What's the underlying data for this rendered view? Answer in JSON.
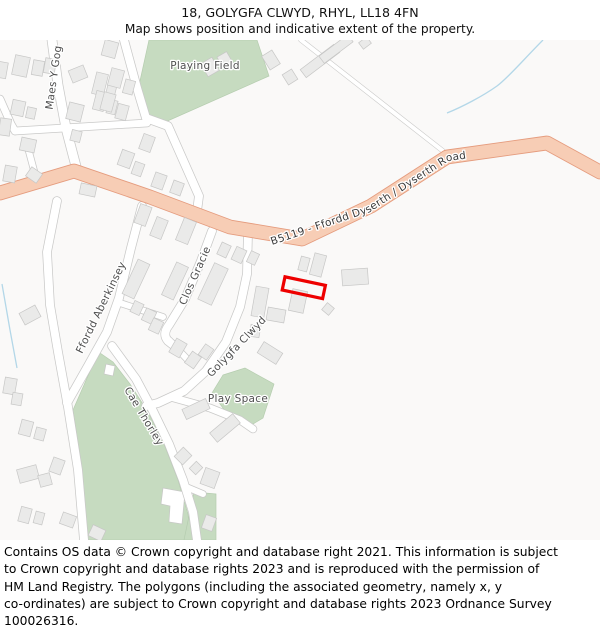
{
  "header": {
    "title": "18, GOLYGFA CLWYD, RHYL, LL18 4FN",
    "subtitle": "Map shows position and indicative extent of the property."
  },
  "map": {
    "colors": {
      "background": "#faf9f8",
      "building_fill": "#eaeae9",
      "building_stroke": "#c7c7c6",
      "road_fill": "#ffffff",
      "road_casing": "#c9c9c8",
      "a_road_fill": "#f7cdb5",
      "a_road_casing": "#e59c7e",
      "green": "#c6dbc0",
      "green_stroke": "#b5cdaf",
      "water": "#b3d7e8",
      "property_outline": "#ee0000",
      "label_color": "#4f4f4f"
    },
    "greens": [
      {
        "name": "playing-field",
        "points": "149,40 257,40 269,76 163,123 148,117 138,90"
      },
      {
        "name": "cae-thorley-field",
        "points": "100,353 113,362 130,384 148,412 164,444 178,480 188,514 190,540 88,540 82,470 73,410 91,369"
      },
      {
        "name": "southeast-green",
        "points": "184,540 194,492 216,494 216,540"
      },
      {
        "name": "play-space-green",
        "points": "223,375 245,368 274,384 263,418 248,427 228,415 212,393"
      }
    ],
    "white_plots": [
      "163,488 185,492 182,524 169,522 170,506 161,504",
      "106,364 115,366 113,376 104,374"
    ],
    "streams": [
      "M 543,40 C 525,58 508,78 497,86 C 483,96 462,107 447,113",
      "M 2,284 L 10,330 L 17,368"
    ],
    "roads": [
      {
        "d": "M 52,40 L 58,85 L 66,128 L 73,155 L 77,170",
        "w": 9
      },
      {
        "d": "M 15,131 L 147,123",
        "w": 7
      },
      {
        "d": "M 0,99 L 11,124 L 15,131",
        "w": 7
      },
      {
        "d": "M 124,40 L 137,88 L 146,118 L 168,126 L 199,196 L 197,211",
        "w": 8
      },
      {
        "d": "M 28,148 L 36,178",
        "w": 6
      },
      {
        "d": "M 57,201 L 47,252 L 50,305 L 58,352 L 68,407 L 78,470 L 84,540",
        "w": 8
      },
      {
        "d": "M 142,206 L 131,248 L 119,298 L 107,332 L 88,366 L 67,403",
        "w": 8
      },
      {
        "d": "M 112,346 L 136,379 L 153,411 L 169,444 L 183,480 L 193,512 L 197,540",
        "w": 8
      },
      {
        "d": "M 184,486 L 203,494",
        "w": 6
      },
      {
        "d": "M 248,232 L 247,274 L 240,307 L 226,342 L 206,371 L 184,391 L 158,403 L 146,406",
        "w": 8
      },
      {
        "d": "M 174,398 L 210,408 L 240,420 L 253,429",
        "w": 7
      },
      {
        "d": "M 212,231 L 201,261 L 185,299 L 169,325 Q 162,334 168,341 L 177,348",
        "w": 8
      },
      {
        "d": "M 120,303 L 163,317",
        "w": 6
      },
      {
        "d": "M 169,340 L 188,360",
        "w": 6
      },
      {
        "d": "M 301,40 L 443,151",
        "w": 4,
        "t": "track"
      },
      {
        "d": "M 0,193 L 74,171 L 150,197 L 230,227 L 302,239 L 371,206 L 447,157 L 547,143 L 600,172",
        "w": 13,
        "t": "a"
      }
    ],
    "buildings": [
      [
        2,
        70,
        10,
        16,
        10
      ],
      [
        21,
        66,
        15,
        20,
        12
      ],
      [
        38,
        68,
        11,
        15,
        10
      ],
      [
        50,
        66,
        11,
        15,
        10
      ],
      [
        78,
        74,
        16,
        13,
        -22
      ],
      [
        100,
        84,
        12,
        22,
        14
      ],
      [
        111,
        91,
        9,
        12,
        14
      ],
      [
        18,
        108,
        13,
        15,
        12
      ],
      [
        31,
        113,
        9,
        11,
        12
      ],
      [
        5,
        127,
        11,
        17,
        8
      ],
      [
        75,
        112,
        15,
        17,
        14
      ],
      [
        100,
        101,
        11,
        19,
        14
      ],
      [
        112,
        107,
        9,
        14,
        14
      ],
      [
        76,
        136,
        10,
        11,
        14
      ],
      [
        28,
        145,
        15,
        13,
        12
      ],
      [
        10,
        174,
        12,
        16,
        10
      ],
      [
        34,
        175,
        13,
        11,
        35
      ],
      [
        110,
        49,
        14,
        16,
        15
      ],
      [
        116,
        78,
        13,
        18,
        15
      ],
      [
        129,
        87,
        10,
        14,
        15
      ],
      [
        108,
        102,
        12,
        18,
        15
      ],
      [
        122,
        112,
        11,
        15,
        15
      ],
      [
        147,
        143,
        12,
        16,
        20
      ],
      [
        126,
        159,
        13,
        16,
        20
      ],
      [
        138,
        169,
        10,
        13,
        20
      ],
      [
        159,
        181,
        12,
        15,
        20
      ],
      [
        177,
        188,
        11,
        13,
        20
      ],
      [
        210,
        67,
        13,
        15,
        -30
      ],
      [
        225,
        60,
        11,
        13,
        -30
      ],
      [
        271,
        60,
        12,
        16,
        -32
      ],
      [
        290,
        77,
        11,
        12,
        -32
      ],
      [
        320,
        61,
        42,
        10,
        -37
      ],
      [
        336,
        49,
        36,
        9,
        -37
      ],
      [
        365,
        43,
        10,
        8,
        -37
      ],
      [
        88,
        190,
        16,
        11,
        12
      ],
      [
        143,
        215,
        12,
        20,
        20
      ],
      [
        159,
        228,
        12,
        20,
        22
      ],
      [
        186,
        231,
        13,
        24,
        22
      ],
      [
        224,
        250,
        10,
        13,
        25
      ],
      [
        239,
        255,
        11,
        14,
        25
      ],
      [
        253,
        258,
        9,
        12,
        25
      ],
      [
        136,
        279,
        13,
        38,
        25
      ],
      [
        175,
        281,
        13,
        36,
        25
      ],
      [
        213,
        284,
        15,
        40,
        25
      ],
      [
        137,
        308,
        10,
        12,
        25
      ],
      [
        149,
        316,
        11,
        13,
        25
      ],
      [
        156,
        326,
        11,
        13,
        25
      ],
      [
        178,
        348,
        12,
        16,
        30
      ],
      [
        193,
        360,
        11,
        14,
        35
      ],
      [
        206,
        352,
        10,
        13,
        35
      ],
      [
        260,
        302,
        13,
        30,
        10
      ],
      [
        276,
        315,
        18,
        13,
        10
      ],
      [
        298,
        301,
        15,
        22,
        12
      ],
      [
        255,
        331,
        10,
        12,
        10
      ],
      [
        270,
        353,
        22,
        13,
        32
      ],
      [
        304,
        264,
        9,
        14,
        15
      ],
      [
        318,
        265,
        12,
        22,
        15
      ],
      [
        355,
        277,
        26,
        16,
        -4
      ],
      [
        328,
        309,
        9,
        9,
        40
      ],
      [
        196,
        409,
        26,
        11,
        -25
      ],
      [
        225,
        428,
        30,
        12,
        -40
      ],
      [
        183,
        456,
        12,
        13,
        45
      ],
      [
        196,
        468,
        9,
        10,
        45
      ],
      [
        210,
        478,
        15,
        17,
        20
      ],
      [
        30,
        315,
        18,
        13,
        -28
      ],
      [
        10,
        386,
        12,
        16,
        10
      ],
      [
        17,
        399,
        10,
        12,
        10
      ],
      [
        26,
        428,
        12,
        15,
        15
      ],
      [
        40,
        434,
        10,
        12,
        15
      ],
      [
        28,
        474,
        20,
        14,
        -15
      ],
      [
        45,
        480,
        12,
        12,
        -15
      ],
      [
        57,
        466,
        12,
        15,
        20
      ],
      [
        25,
        515,
        11,
        15,
        15
      ],
      [
        39,
        518,
        9,
        12,
        15
      ],
      [
        68,
        520,
        14,
        12,
        20
      ],
      [
        97,
        533,
        14,
        12,
        25
      ],
      [
        209,
        523,
        11,
        14,
        20
      ]
    ],
    "street_labels": [
      {
        "text": "Playing Field",
        "x": 205,
        "y": 69,
        "rot": 0,
        "size": 10.5
      },
      {
        "text": "Maes Y Gog",
        "x": 57,
        "y": 78,
        "rot": -82,
        "size": 10.5
      },
      {
        "text": "Clos Gracie",
        "x": 198,
        "y": 277,
        "rot": -66,
        "size": 10.5
      },
      {
        "text": "Ffordd Aberkinsey",
        "x": 104,
        "y": 309,
        "rot": -64,
        "size": 10.5
      },
      {
        "text": "Golygfa Clwyd",
        "x": 239,
        "y": 349,
        "rot": -46,
        "size": 10.5
      },
      {
        "text": "Cae Thorley",
        "x": 141,
        "y": 418,
        "rot": 59,
        "size": 10.5
      },
      {
        "text": "Play Space",
        "x": 238,
        "y": 402,
        "rot": 0,
        "size": 10.5
      }
    ],
    "a_road_label": {
      "text": "B5119 - Ffordd Dyserth / Dyserth Road",
      "path": "M 272,245 L 370,212 L 449,161 L 532,149"
    },
    "property_outline": {
      "cx": 303.8,
      "cy": 287.7,
      "w": 41.3,
      "h": 13.5,
      "rot": 12
    }
  },
  "footer": {
    "lines": [
      "Contains OS data © Crown copyright and database right 2021. This information is subject",
      "to Crown copyright and database rights 2023 and is reproduced with the permission of",
      "HM Land Registry. The polygons (including the associated geometry, namely x, y",
      "co-ordinates) are subject to Crown copyright and database rights 2023 Ordnance Survey",
      "100026316."
    ]
  }
}
